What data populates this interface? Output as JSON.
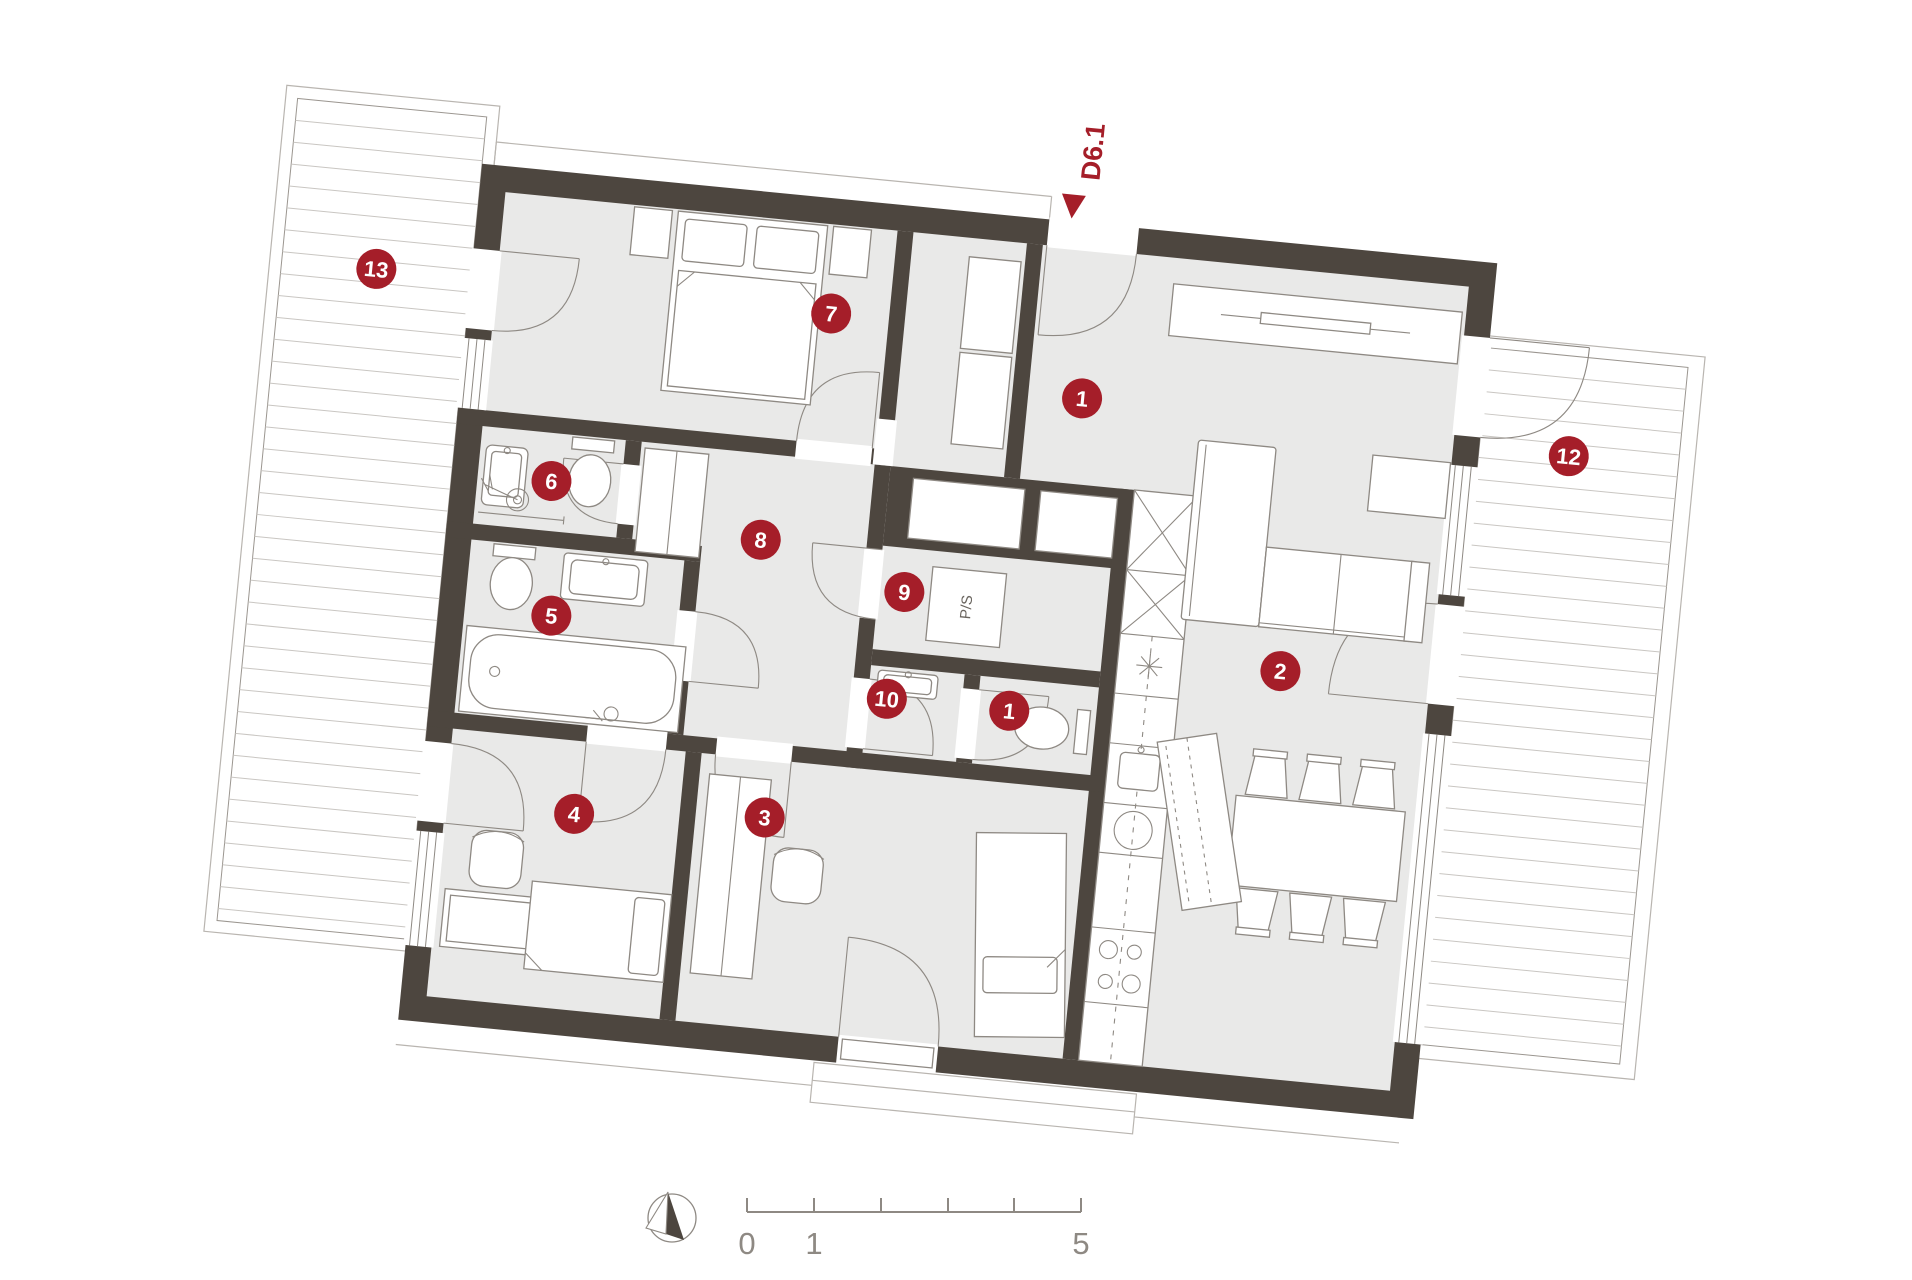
{
  "plan": {
    "door_label": "D6.1",
    "appliance_label": "P/S",
    "colors": {
      "wall": "#4d463f",
      "floor": "#e9e9e8",
      "accent_red": "#a51e29",
      "line": "#8e8983",
      "light_line": "#b9b5b0"
    },
    "markers": [
      {
        "id": "living-room",
        "label": "1"
      },
      {
        "id": "kitchen-dining",
        "label": "2"
      },
      {
        "id": "bedroom-3",
        "label": "3"
      },
      {
        "id": "bedroom-4",
        "label": "4"
      },
      {
        "id": "bathroom-5",
        "label": "5"
      },
      {
        "id": "shower-room-6",
        "label": "6"
      },
      {
        "id": "bedroom-7",
        "label": "7"
      },
      {
        "id": "hallway-8",
        "label": "8"
      },
      {
        "id": "utility-9",
        "label": "9"
      },
      {
        "id": "wc-10",
        "label": "10"
      },
      {
        "id": "wc-1",
        "label": "1"
      },
      {
        "id": "terrace-12",
        "label": "12"
      },
      {
        "id": "terrace-13",
        "label": "13"
      }
    ],
    "scale_bar": {
      "label_start": "0",
      "label_one": "1",
      "label_end": "5"
    }
  }
}
